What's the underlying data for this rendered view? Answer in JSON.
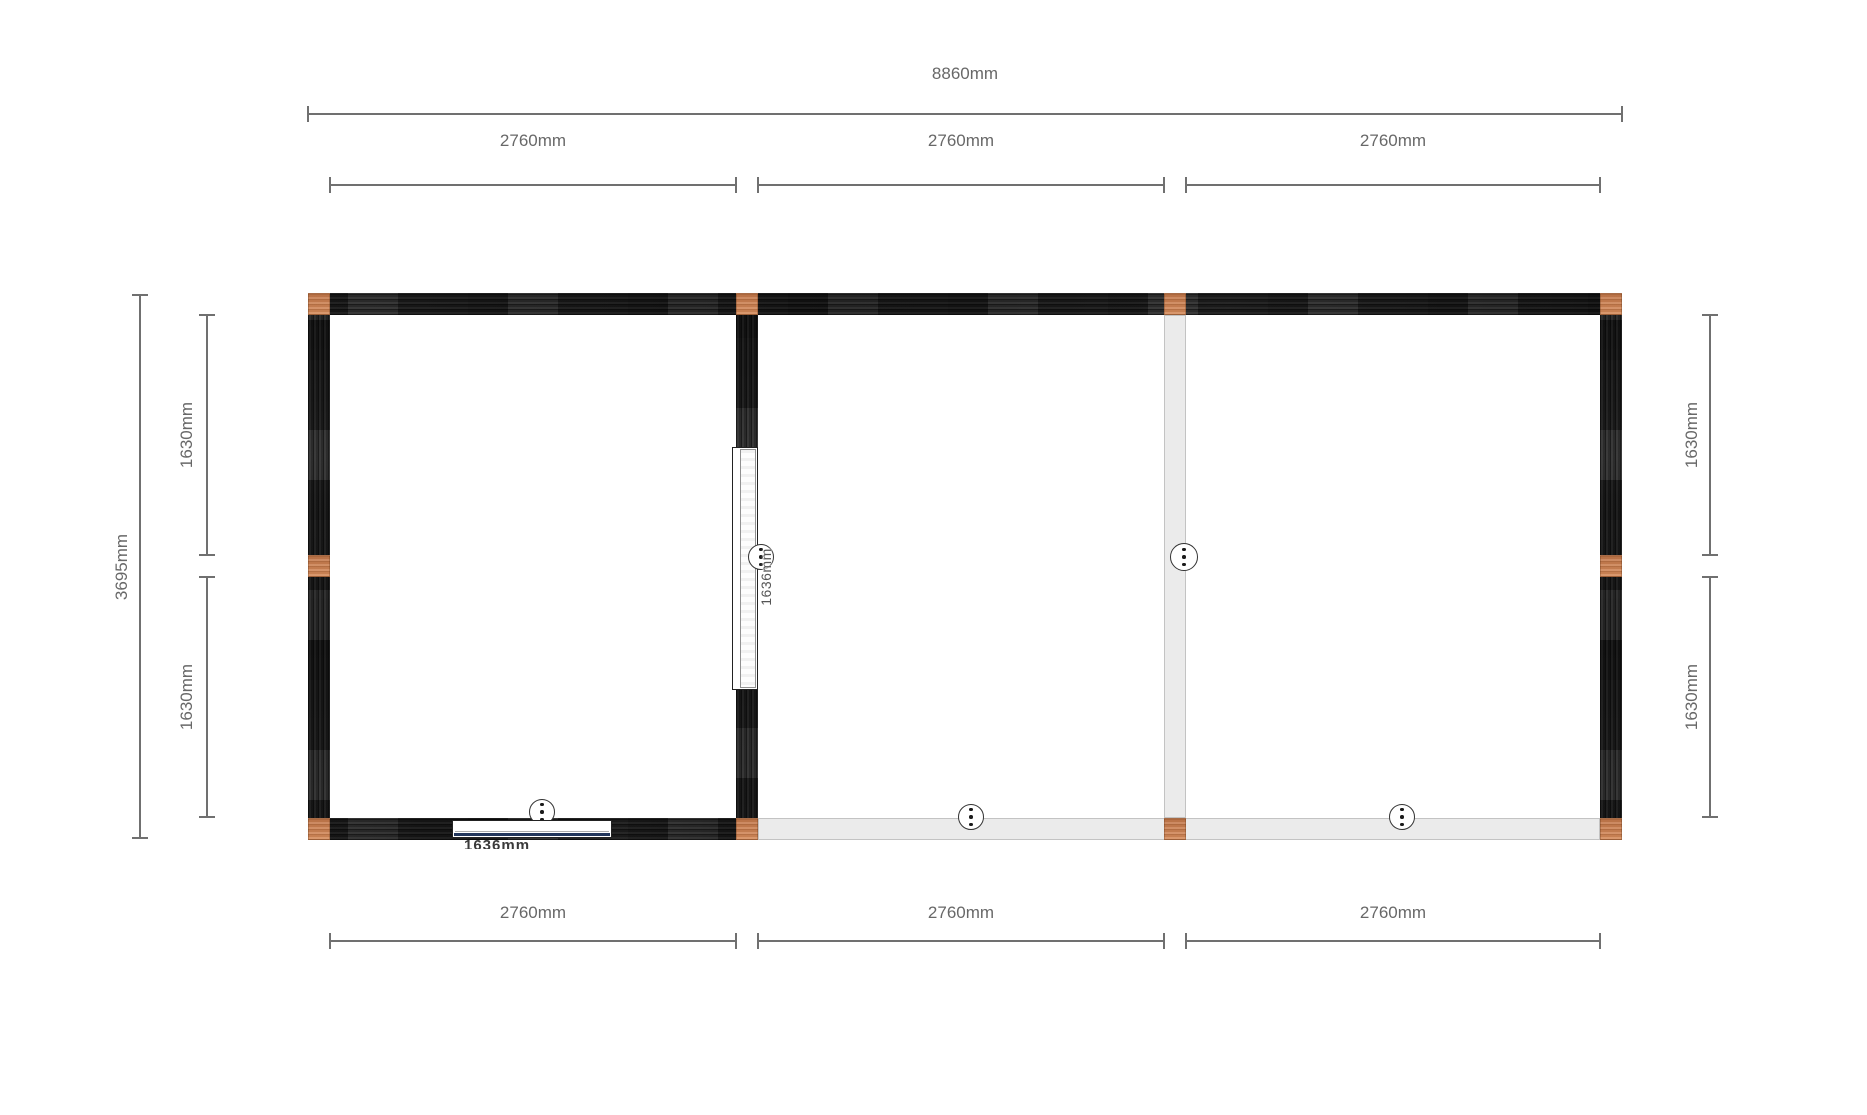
{
  "app": {
    "view": "floor-plan-configurator",
    "background": "#ffffff"
  },
  "colors": {
    "wall_dark": "#232323",
    "wall_light": "#ebebeb",
    "wall_light_border": "#c3c3c3",
    "post_orange": "#cd8054",
    "dimension_line": "#707070",
    "dimension_text": "#686868",
    "door_border": "#222222",
    "door_front_bottom_line": "#22365c",
    "connector_border": "#333333",
    "connector_dot": "#1a1a1a"
  },
  "dims": {
    "top_total": "8860mm",
    "top_bays": [
      "2760mm",
      "2760mm",
      "2760mm"
    ],
    "bottom_bays": [
      "2760mm",
      "2760mm",
      "2760mm"
    ],
    "left_total": "3695mm",
    "left_segments": [
      "1630mm",
      "1630mm"
    ],
    "right_segments": [
      "1630mm",
      "1630mm"
    ]
  },
  "doors": {
    "side_label": "1636mm",
    "front_label": "1636mm"
  },
  "icons": {
    "connector": "connector-3-dots-icon"
  }
}
